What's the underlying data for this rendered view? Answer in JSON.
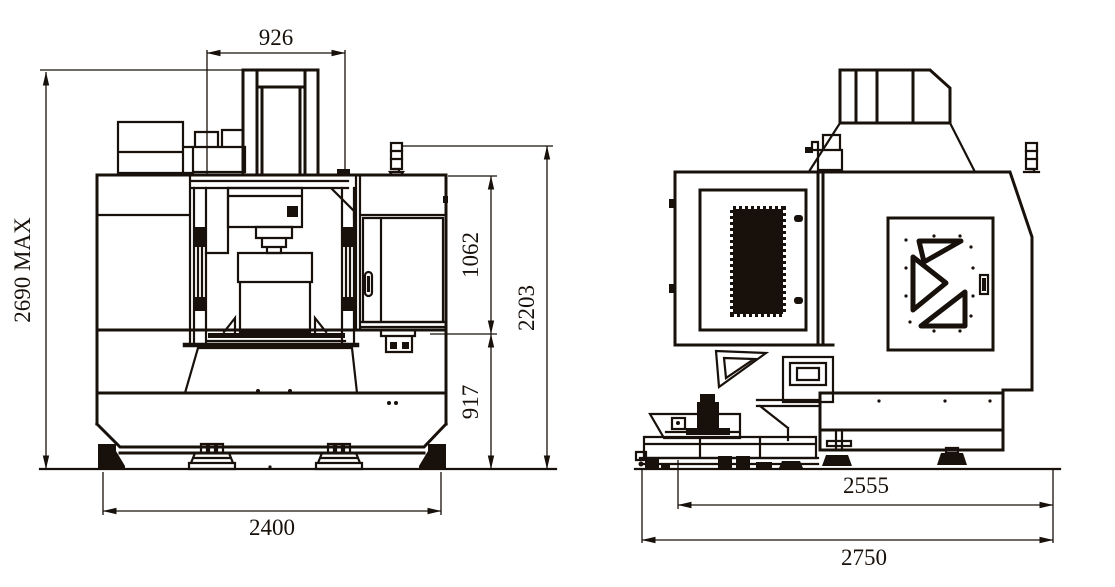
{
  "meta": {
    "background": "#ffffff",
    "line_color": "#18100a",
    "drawing_type": "machine outline drawing, front and side views"
  },
  "views": {
    "front": {
      "dimensions": {
        "head_width": "926",
        "max_height": "2690 MAX",
        "spindle_to_table": "1062",
        "enclosure_height": "2203",
        "table_to_floor": "917",
        "overall_width": "2400"
      }
    },
    "side": {
      "dimensions": {
        "body_depth": "2555",
        "overall_depth": "2750"
      }
    }
  }
}
